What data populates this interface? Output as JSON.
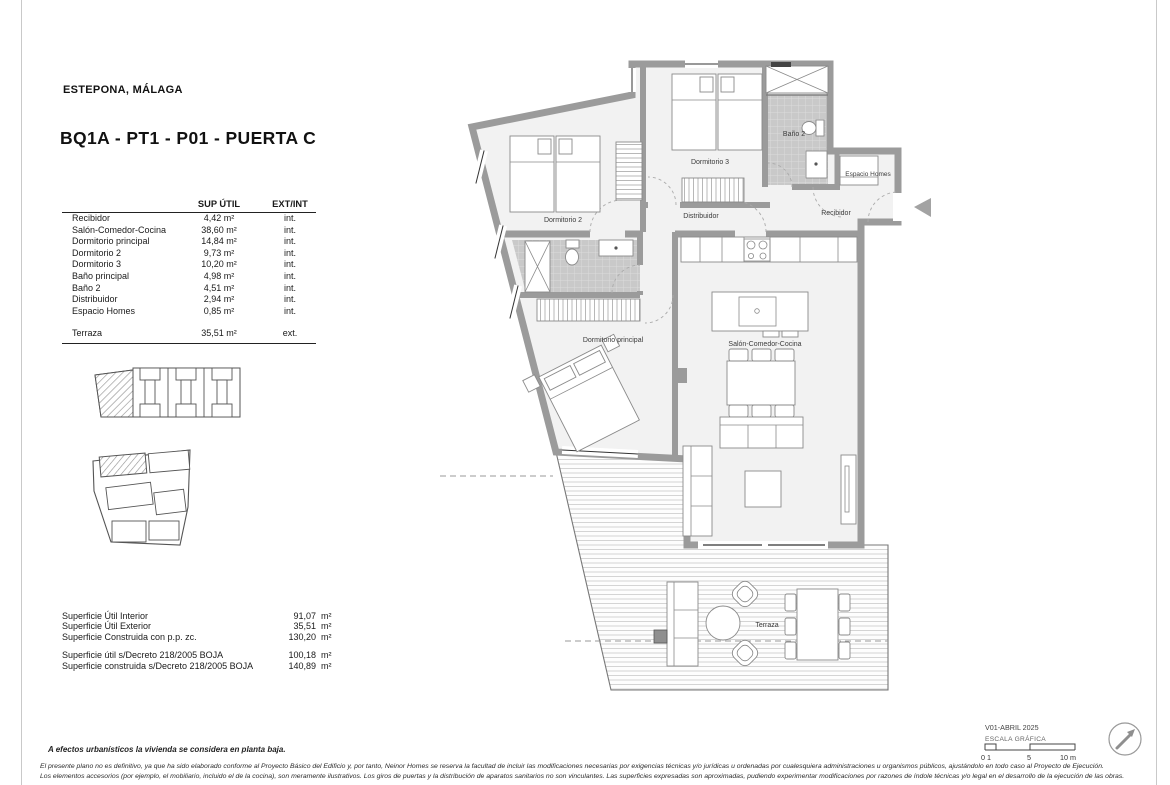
{
  "meta": {
    "location": "ESTEPONA, MÁLAGA",
    "title": "BQ1A - PT1 - P01 -  PUERTA C"
  },
  "areas_table": {
    "headers": {
      "sup": "SUP ÚTIL",
      "ext": "EXT/INT"
    },
    "rows": [
      {
        "name": "Recibidor",
        "sup": "4,42 m²",
        "ext": "int."
      },
      {
        "name": "Salón-Comedor-Cocina",
        "sup": "38,60 m²",
        "ext": "int."
      },
      {
        "name": "Dormitorio principal",
        "sup": "14,84 m²",
        "ext": "int."
      },
      {
        "name": "Dormitorio 2",
        "sup": "9,73 m²",
        "ext": "int."
      },
      {
        "name": "Dormitorio 3",
        "sup": "10,20 m²",
        "ext": "int."
      },
      {
        "name": "Baño principal",
        "sup": "4,98 m²",
        "ext": "int."
      },
      {
        "name": "Baño 2",
        "sup": "4,51 m²",
        "ext": "int."
      },
      {
        "name": "Distribuidor",
        "sup": "2,94 m²",
        "ext": "int."
      },
      {
        "name": "Espacio Homes",
        "sup": "0,85 m²",
        "ext": "int."
      }
    ],
    "terraza": {
      "name": "Terraza",
      "sup": "35,51 m²",
      "ext": "ext."
    }
  },
  "summary": {
    "rows": [
      {
        "label": "Superficie Útil Interior",
        "value": "91,07",
        "unit": "m²"
      },
      {
        "label": "Superficie Útil Exterior",
        "value": "35,51",
        "unit": "m²"
      },
      {
        "label": "Superficie Construida con p.p. zc.",
        "value": "130,20",
        "unit": "m²"
      },
      {
        "label": "Superficie útil s/Decreto 218/2005 BOJA",
        "value": "100,18",
        "unit": "m²"
      },
      {
        "label": "Superficie construida s/Decreto 218/2005 BOJA",
        "value": "140,89",
        "unit": "m²"
      }
    ]
  },
  "plan": {
    "labels": {
      "dormitorio2": "Dormitorio 2",
      "dormitorio3": "Dormitorio 3",
      "bano2": "Baño 2",
      "espacio_homes": "Espacio Homes",
      "recibidor": "Recibidor",
      "distribuidor": "Distribuidor",
      "dormitorio_principal": "Dormitorio principal",
      "salon": "Salón-Comedor-Cocina",
      "terraza": "Terraza"
    }
  },
  "titleblock": {
    "version": "V01-ABRIL 2025",
    "scale_label": "ESCALA GRÁFICA",
    "scale_ticks": [
      "0 1",
      "5",
      "10 m"
    ]
  },
  "footer": {
    "note": "A efectos urbanísticos la vivienda se considera en planta baja.",
    "disclaimer1": "El presente plano no es definitivo, ya que ha sido elaborado conforme al Proyecto Básico del Edificio y, por tanto, Neinor Homes se reserva la facultad de incluir las modificaciones necesarias por exigencias técnicas y/o jurídicas u ordenadas por cualesquiera administraciones u organismos públicos, ajustándolo en todo caso al Proyecto de Ejecución.",
    "disclaimer2": "Los elementos accesorios (por ejemplo, el mobiliario, incluido el de la cocina), son meramente ilustrativos. Los giros de puertas y la distribución de aparatos sanitarios no son vinculantes. Las superficies expresadas son aproximadas, pudiendo experimentar modificaciones por razones de índole técnicas y/o legal en el desarrollo de la ejecución de las obras."
  }
}
